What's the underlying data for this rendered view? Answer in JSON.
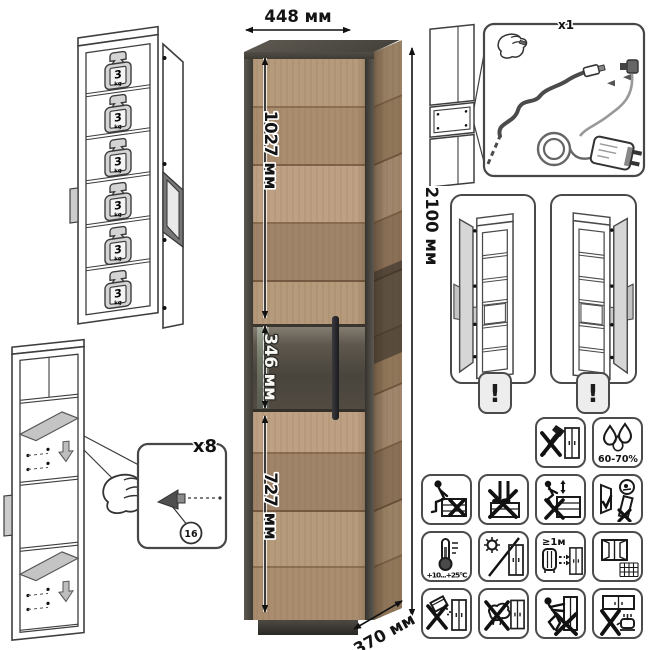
{
  "dimensions": {
    "width": "448 мм",
    "upper_door": "1027 мм",
    "middle_section": "346 мм",
    "lower_door": "727 мм",
    "height": "2100 мм",
    "depth": "370 мм"
  },
  "load": {
    "value": "3",
    "unit": "kg"
  },
  "assembly": {
    "fastener_qty": "x8",
    "part_label": "16"
  },
  "led": {
    "kit_qty": "x1"
  },
  "warning": {
    "mark": "!"
  },
  "care": {
    "humidity": "60-70%",
    "temperature": "+10...+25°C",
    "heater_distance": "≥1м"
  },
  "colors": {
    "wood": "#b0946f",
    "frame": "#4b4740",
    "glass": "#4c473f",
    "line": "#2a2a2a",
    "badge_bg": "#ededed"
  },
  "icons": [
    "weight-3kg-icon",
    "shelf-support-icon",
    "hand-icon",
    "led-cable-icon",
    "power-adapter-icon",
    "exclamation-icon",
    "no-axe-icon",
    "humidity-icon",
    "no-sitting-icon",
    "no-standing-icon",
    "no-climbing-icon",
    "door-warning-icon",
    "temperature-icon",
    "no-sunlight-icon",
    "heater-distance-icon",
    "ventilation-icon",
    "no-abrasive-icon",
    "no-wet-cloth-icon",
    "no-dragging-icon",
    "no-heat-below-icon"
  ]
}
